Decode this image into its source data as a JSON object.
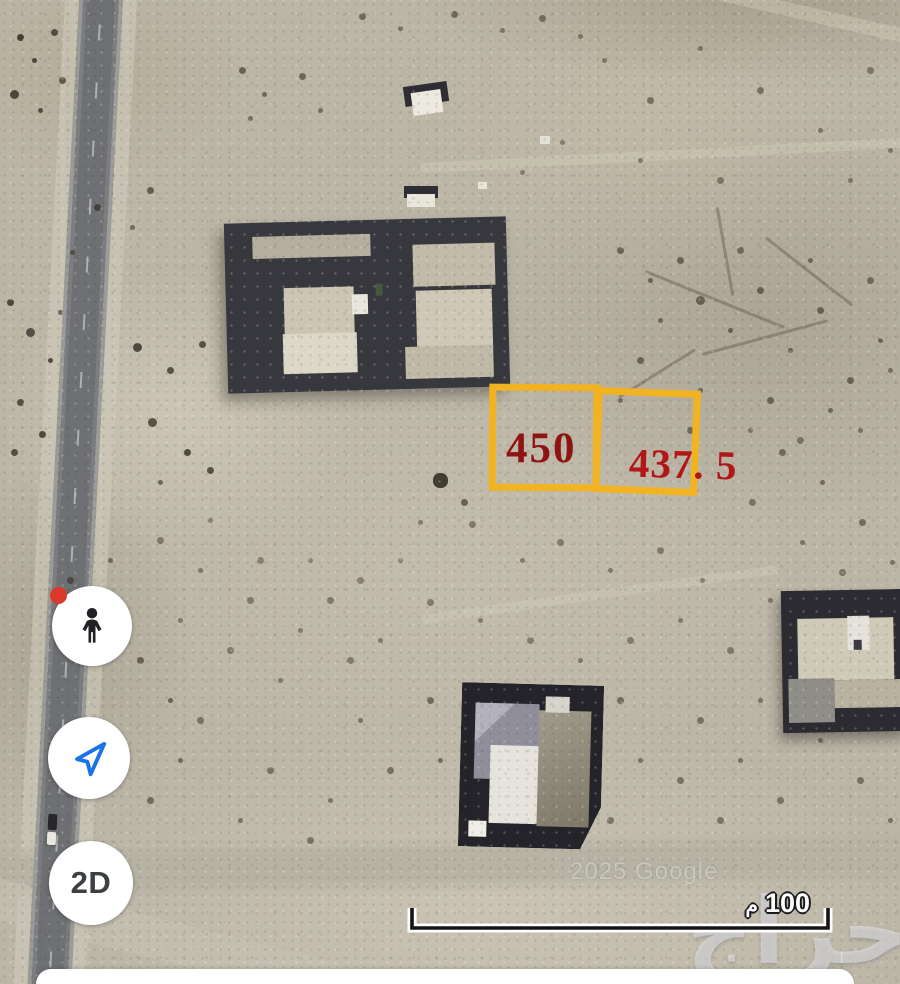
{
  "map": {
    "annotations": {
      "outline_color": "#F2B322",
      "plots": [
        {
          "label": "450",
          "label_color": "#8E1313"
        },
        {
          "label": "437. 5",
          "label_color": "#B21717"
        }
      ]
    },
    "scale_bar": {
      "distance": "100",
      "unit": "م"
    },
    "watermarks": {
      "imagery_credit": "2025 Google",
      "brand": "حراج"
    }
  },
  "controls": {
    "pegman_button": {
      "icon": "pegman-icon",
      "badge_color": "#D93A2B"
    },
    "my_location_button": {
      "icon": "navigation-arrow-icon",
      "arrow_color": "#1A73E8"
    },
    "map_mode_button": {
      "label": "2D"
    }
  }
}
